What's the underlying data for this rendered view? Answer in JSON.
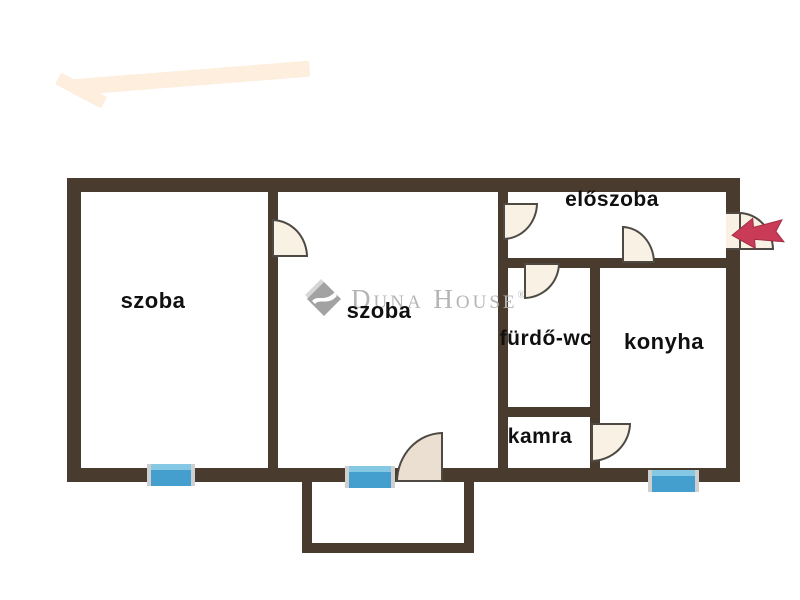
{
  "watermark": {
    "brand": "Duna House",
    "registered": "®"
  },
  "floorplan": {
    "rooms": [
      {
        "id": "szoba-1",
        "label": "szoba"
      },
      {
        "id": "szoba-2",
        "label": "szoba"
      },
      {
        "id": "eloszoba",
        "label": "előszoba"
      },
      {
        "id": "furdo-wc",
        "label": "fürdő-wc"
      },
      {
        "id": "konyha",
        "label": "konyha"
      },
      {
        "id": "kamra",
        "label": "kamra"
      }
    ],
    "features": {
      "windows": 3,
      "door_swings": 7,
      "balcony": true,
      "entrance_side": "right",
      "entrance_arrow_direction": "left"
    },
    "colors": {
      "wall": "#4a3b2f",
      "door-fill": "#f8f1e4",
      "door-fill-dark": "#eadfd0",
      "door-outline": "#4e4a43",
      "window-blue": "#459fce",
      "window-blue-light": "#85c8e4",
      "window-cap": "#cfcfcf",
      "arrow-red": "#c93b56",
      "logo-gray": "#b5b5b5",
      "swoosh-peach": "#fdeedd"
    }
  }
}
